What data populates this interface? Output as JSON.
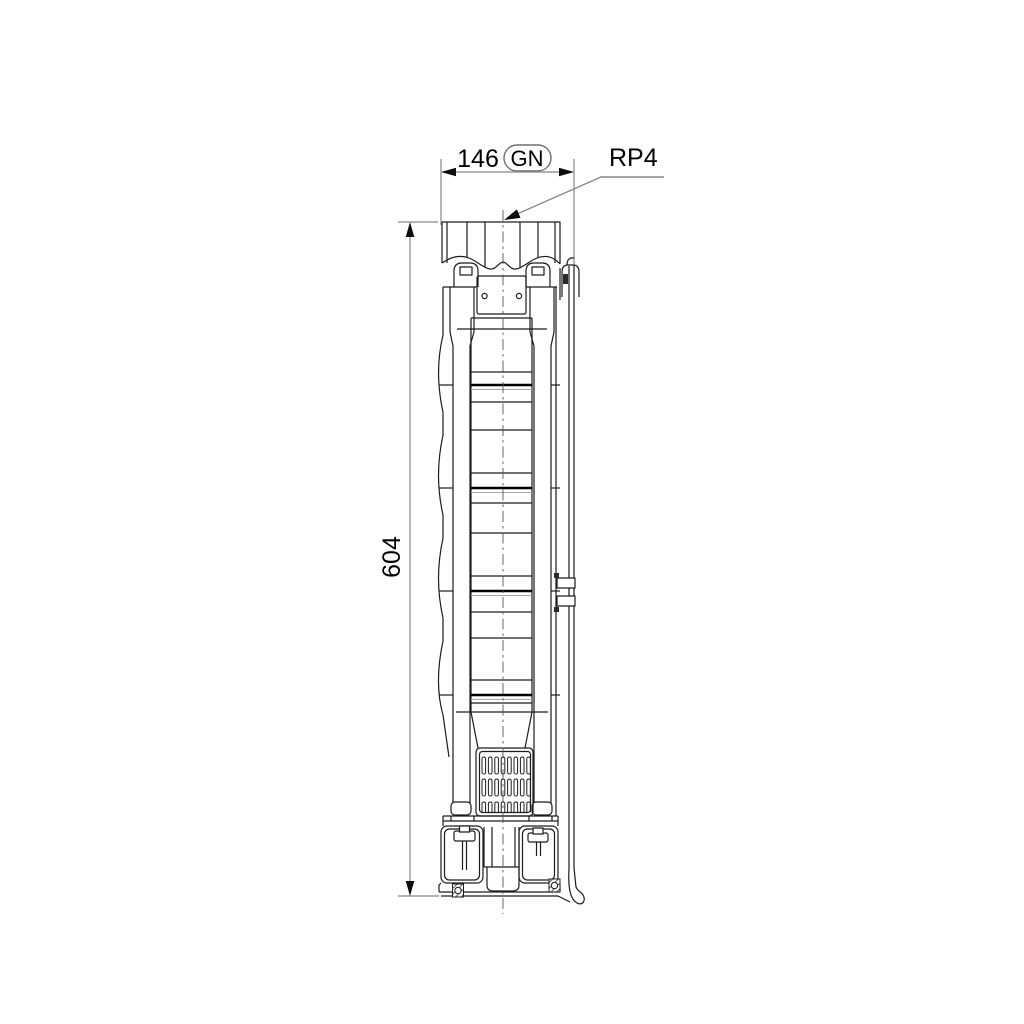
{
  "page": {
    "type": "technical-dimensional-drawing",
    "background": "#ffffff"
  },
  "drawing": {
    "dimensions": {
      "width": {
        "value": "146",
        "badge": "GN"
      },
      "height": {
        "value": "604"
      }
    },
    "connection": {
      "label": "RP4"
    },
    "colors": {
      "line": "#1c1c1c",
      "thick_line": "#000000",
      "light_line": "#a6a6a6",
      "dim_line": "#9a9a9a",
      "text": "#000000"
    }
  }
}
